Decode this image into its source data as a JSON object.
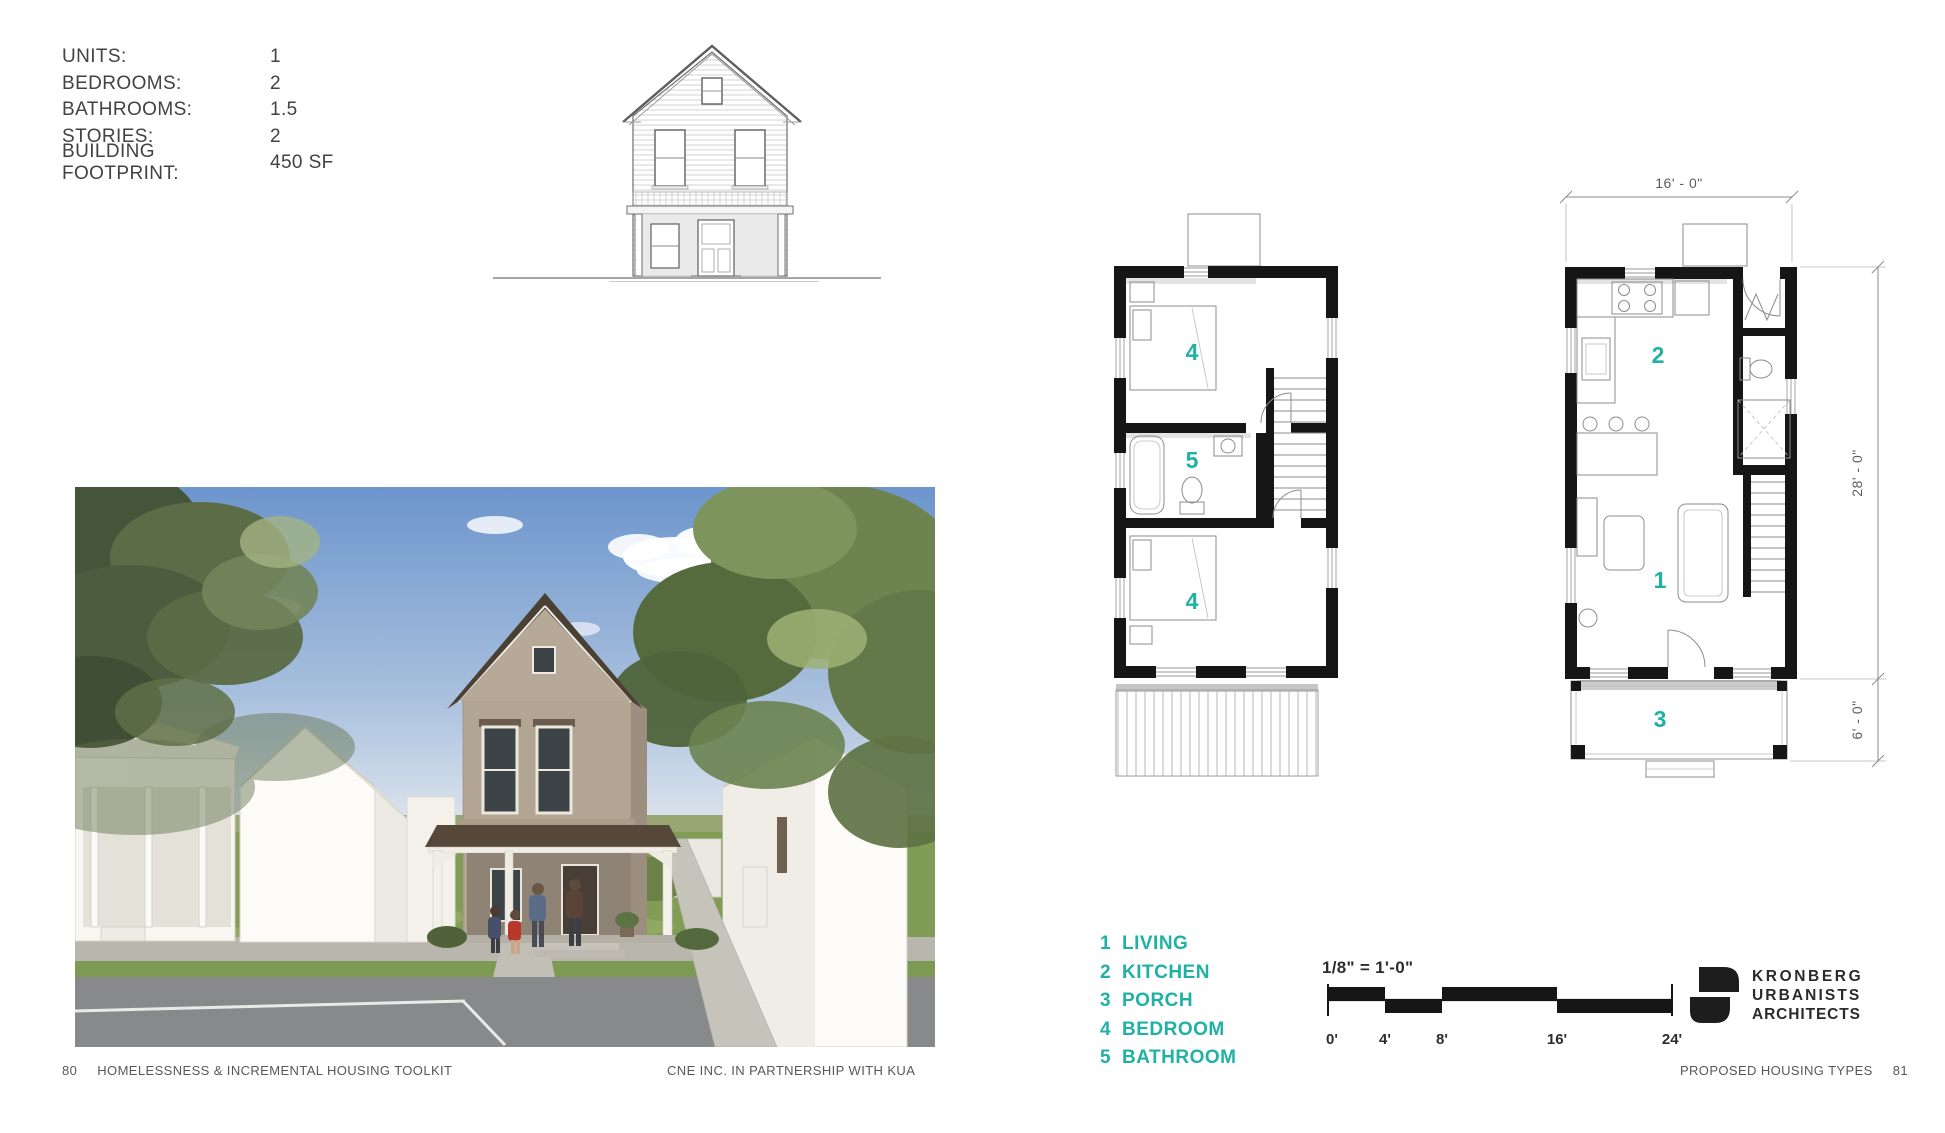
{
  "colors": {
    "accent": "#1fb1a4",
    "ink": "#414244",
    "muted": "#57585b",
    "plan_wall": "#161616"
  },
  "specs": {
    "rows": [
      {
        "label": "UNITS:",
        "value": "1"
      },
      {
        "label": "BEDROOMS:",
        "value": "2"
      },
      {
        "label": "BATHROOMS:",
        "value": "1.5"
      },
      {
        "label": "STORIES:",
        "value": "2"
      },
      {
        "label": "BUILDING FOOTPRINT:",
        "value": "450 SF"
      }
    ]
  },
  "plans": {
    "second": {
      "rooms": [
        "4",
        "5",
        "4"
      ]
    },
    "first": {
      "rooms": [
        "2",
        "1",
        "3"
      ]
    },
    "dims": {
      "width": "16' - 0\"",
      "height": "28' - 0\"",
      "porch": "6' - 0\""
    }
  },
  "legend": {
    "items": [
      {
        "num": "1",
        "label": "LIVING"
      },
      {
        "num": "2",
        "label": "KITCHEN"
      },
      {
        "num": "3",
        "label": "PORCH"
      },
      {
        "num": "4",
        "label": "BEDROOM"
      },
      {
        "num": "5",
        "label": "BATHROOM"
      }
    ]
  },
  "scale": {
    "label": "1/8\" = 1'-0\"",
    "ticks": [
      "0'",
      "4'",
      "8'",
      "16'",
      "24'"
    ]
  },
  "logo": {
    "line1": "KRONBERG",
    "line2": "URBANISTS",
    "line3": "ARCHITECTS"
  },
  "footer": {
    "page_left": "80",
    "left_title": "HOMELESSNESS & INCREMENTAL HOUSING TOOLKIT",
    "center": "CNE INC. IN PARTNERSHIP WITH KUA",
    "right_title": "PROPOSED HOUSING TYPES",
    "page_right": "81"
  }
}
